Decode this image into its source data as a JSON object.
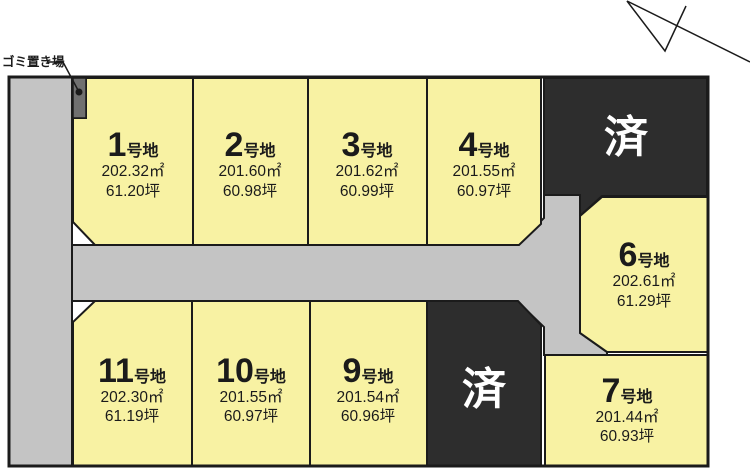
{
  "colors": {
    "plot_fill": "#f8f2a3",
    "road_fill": "#c4c4c4",
    "sold_fill": "#2d2d2d",
    "garbage_fill": "#707070",
    "border": "#1b1b1b",
    "sold_text": "#ffffff",
    "background": "#ffffff"
  },
  "legend": {
    "garbage_label": "ゴミ置き場",
    "lot_suffix": "号地",
    "sold_label": "済"
  },
  "plots": [
    {
      "number": "1",
      "area_m2": "202.32㎡",
      "area_tsubo": "61.20坪"
    },
    {
      "number": "2",
      "area_m2": "201.60㎡",
      "area_tsubo": "60.98坪"
    },
    {
      "number": "3",
      "area_m2": "201.62㎡",
      "area_tsubo": "60.99坪"
    },
    {
      "number": "4",
      "area_m2": "201.55㎡",
      "area_tsubo": "60.97坪"
    },
    {
      "number": "6",
      "area_m2": "202.61㎡",
      "area_tsubo": "61.29坪"
    },
    {
      "number": "7",
      "area_m2": "201.44㎡",
      "area_tsubo": "60.93坪"
    },
    {
      "number": "9",
      "area_m2": "201.54㎡",
      "area_tsubo": "60.96坪"
    },
    {
      "number": "10",
      "area_m2": "201.55㎡",
      "area_tsubo": "60.97坪"
    },
    {
      "number": "11",
      "area_m2": "202.30㎡",
      "area_tsubo": "61.19坪"
    }
  ],
  "sold_plots": [
    {
      "label": "済"
    },
    {
      "label": "済"
    }
  ]
}
